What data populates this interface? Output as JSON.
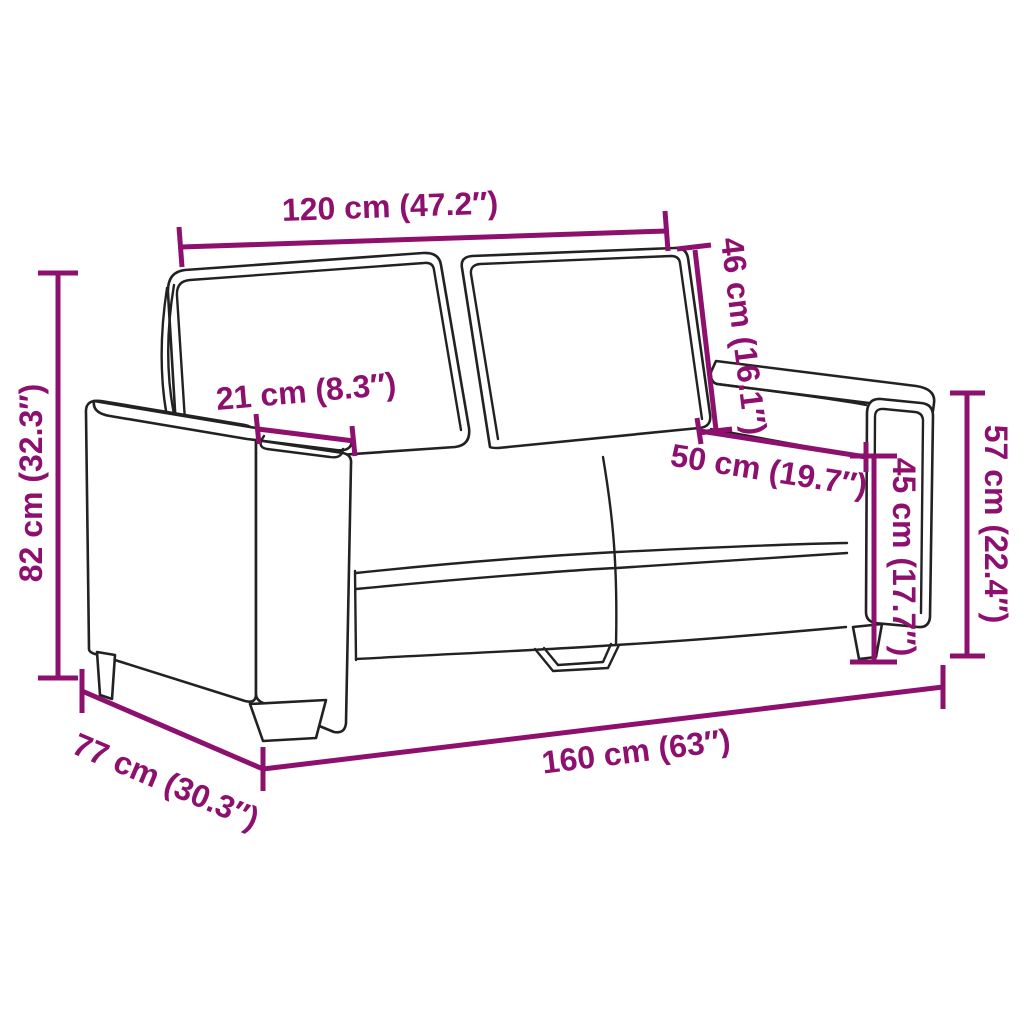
{
  "diagram": {
    "subject": "two-seater-sofa-line-drawing",
    "colors": {
      "dimension": "#8E106E",
      "outline": "#222222",
      "background": "#ffffff"
    },
    "dimensions": [
      {
        "name": "seat-width-top",
        "label": "120 cm (47.2″)"
      },
      {
        "name": "backrest-height",
        "label": "46 cm (16.1″)"
      },
      {
        "name": "armrest-width",
        "label": "21 cm (8.3″)"
      },
      {
        "name": "overall-height",
        "label": "82 cm (32.3″)"
      },
      {
        "name": "seat-depth",
        "label": "50 cm (19.7″)"
      },
      {
        "name": "seat-height",
        "label": "45 cm (17.7″)"
      },
      {
        "name": "armrest-height",
        "label": "57 cm (22.4″)"
      },
      {
        "name": "overall-depth",
        "label": "77 cm (30.3″)"
      },
      {
        "name": "overall-width",
        "label": "160 cm (63″)"
      }
    ]
  }
}
